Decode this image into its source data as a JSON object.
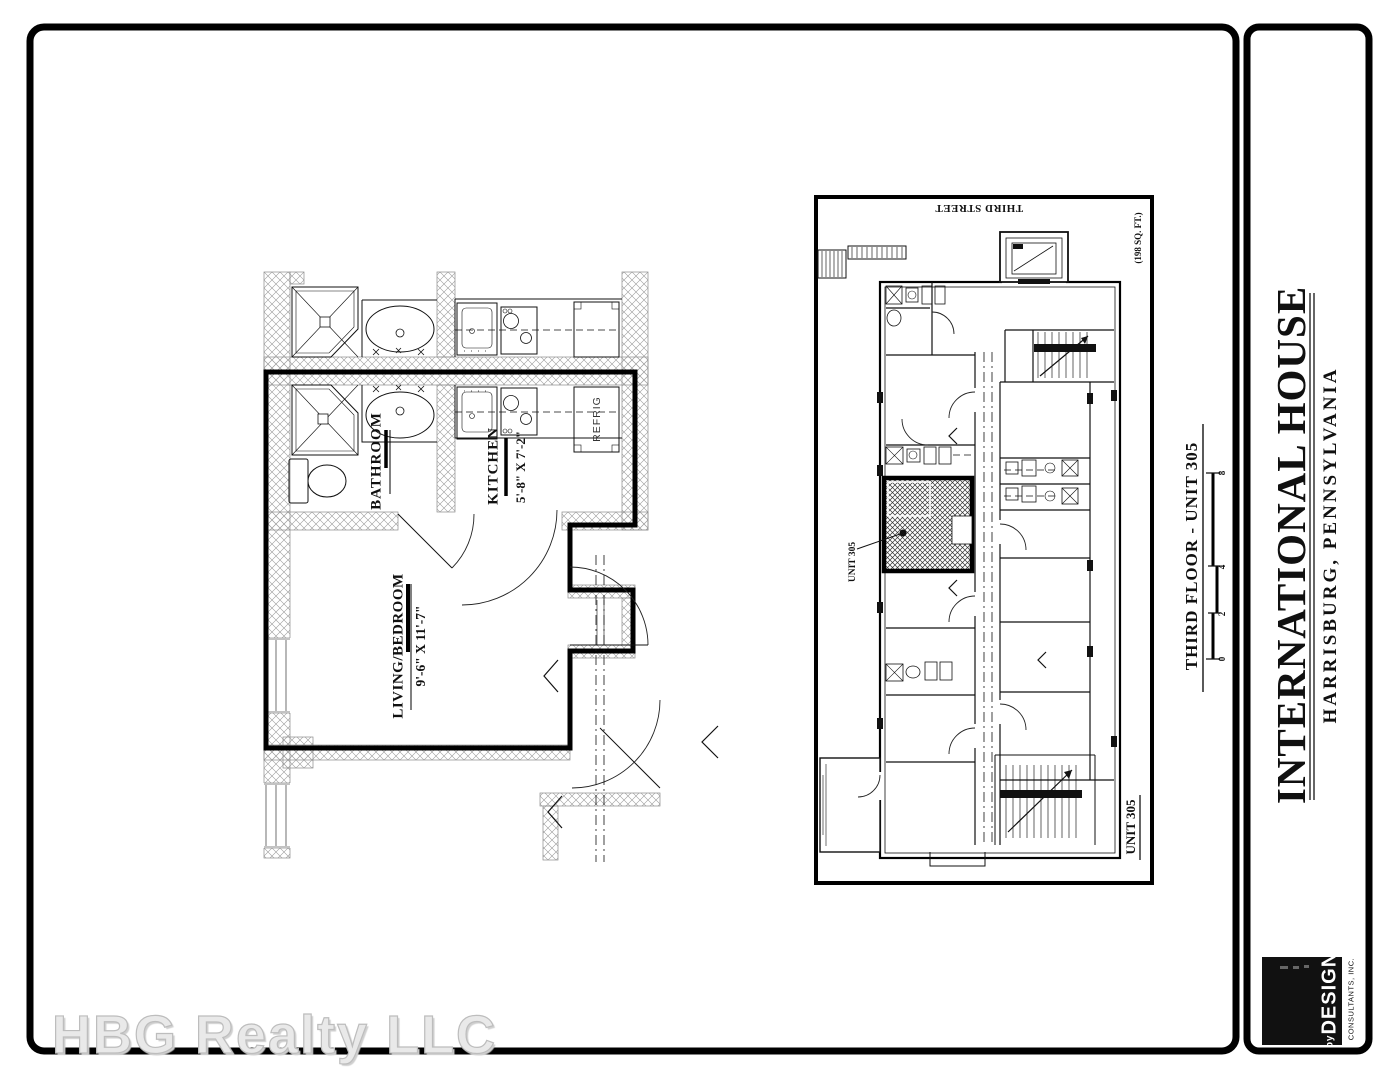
{
  "colors": {
    "paper": "#ffffff",
    "ink": "#000000",
    "watermark_fill": "#e9e9e9",
    "watermark_outline": "#bdbdbd"
  },
  "watermark": {
    "text": "HBG Realty LLC"
  },
  "title_block": {
    "project_title": "INTERNATIONAL HOUSE",
    "project_location": "HARRISBURG, PENNSYLVANIA",
    "logo": {
      "prefix": "by",
      "brand": "DESIGN",
      "subtext": "CONSULTANTS, INC."
    }
  },
  "unit_plan": {
    "room_labels": {
      "bathroom": "BATHROOM",
      "kitchen": "KITCHEN",
      "kitchen_dims": "5'-8\" X 7'-2\"",
      "living": "LIVING/BEDROOM",
      "living_dims": "9'-6\" X 11'-7\"",
      "refrigerator": "REFRIG"
    }
  },
  "key_plan": {
    "street_label": "THIRD STREET",
    "area_note": "(198 SQ. FT.)",
    "unit_callout": "UNIT 305",
    "unit_corner_label": "UNIT 305"
  },
  "plan_caption": {
    "title": "THIRD FLOOR - UNIT 305",
    "scale_ticks": [
      "0",
      "2",
      "4",
      "8"
    ]
  }
}
